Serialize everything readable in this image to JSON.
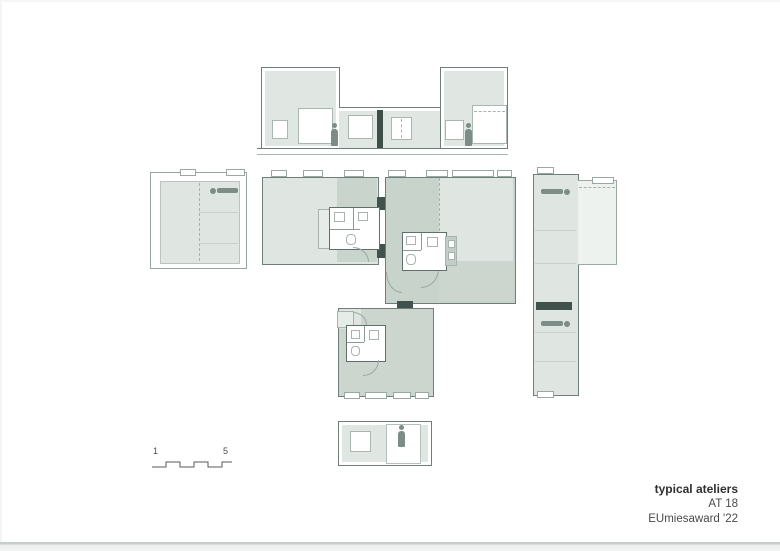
{
  "caption": {
    "title": "typical ateliers",
    "project": "AT 18",
    "award": "EUmiesaward '22"
  },
  "scale_bar": {
    "start_label": "1",
    "end_label": "5"
  },
  "palette": {
    "fill_light": "#dfe6e1",
    "fill_extra_light": "#eef2ee",
    "fill_medium": "#ccd6cf",
    "fill_dark": "#c8d3cc",
    "wall_dark": "#41514c",
    "outline": "#6e7e78",
    "figure": "#7b8d86",
    "page_background": "#ffffff"
  }
}
